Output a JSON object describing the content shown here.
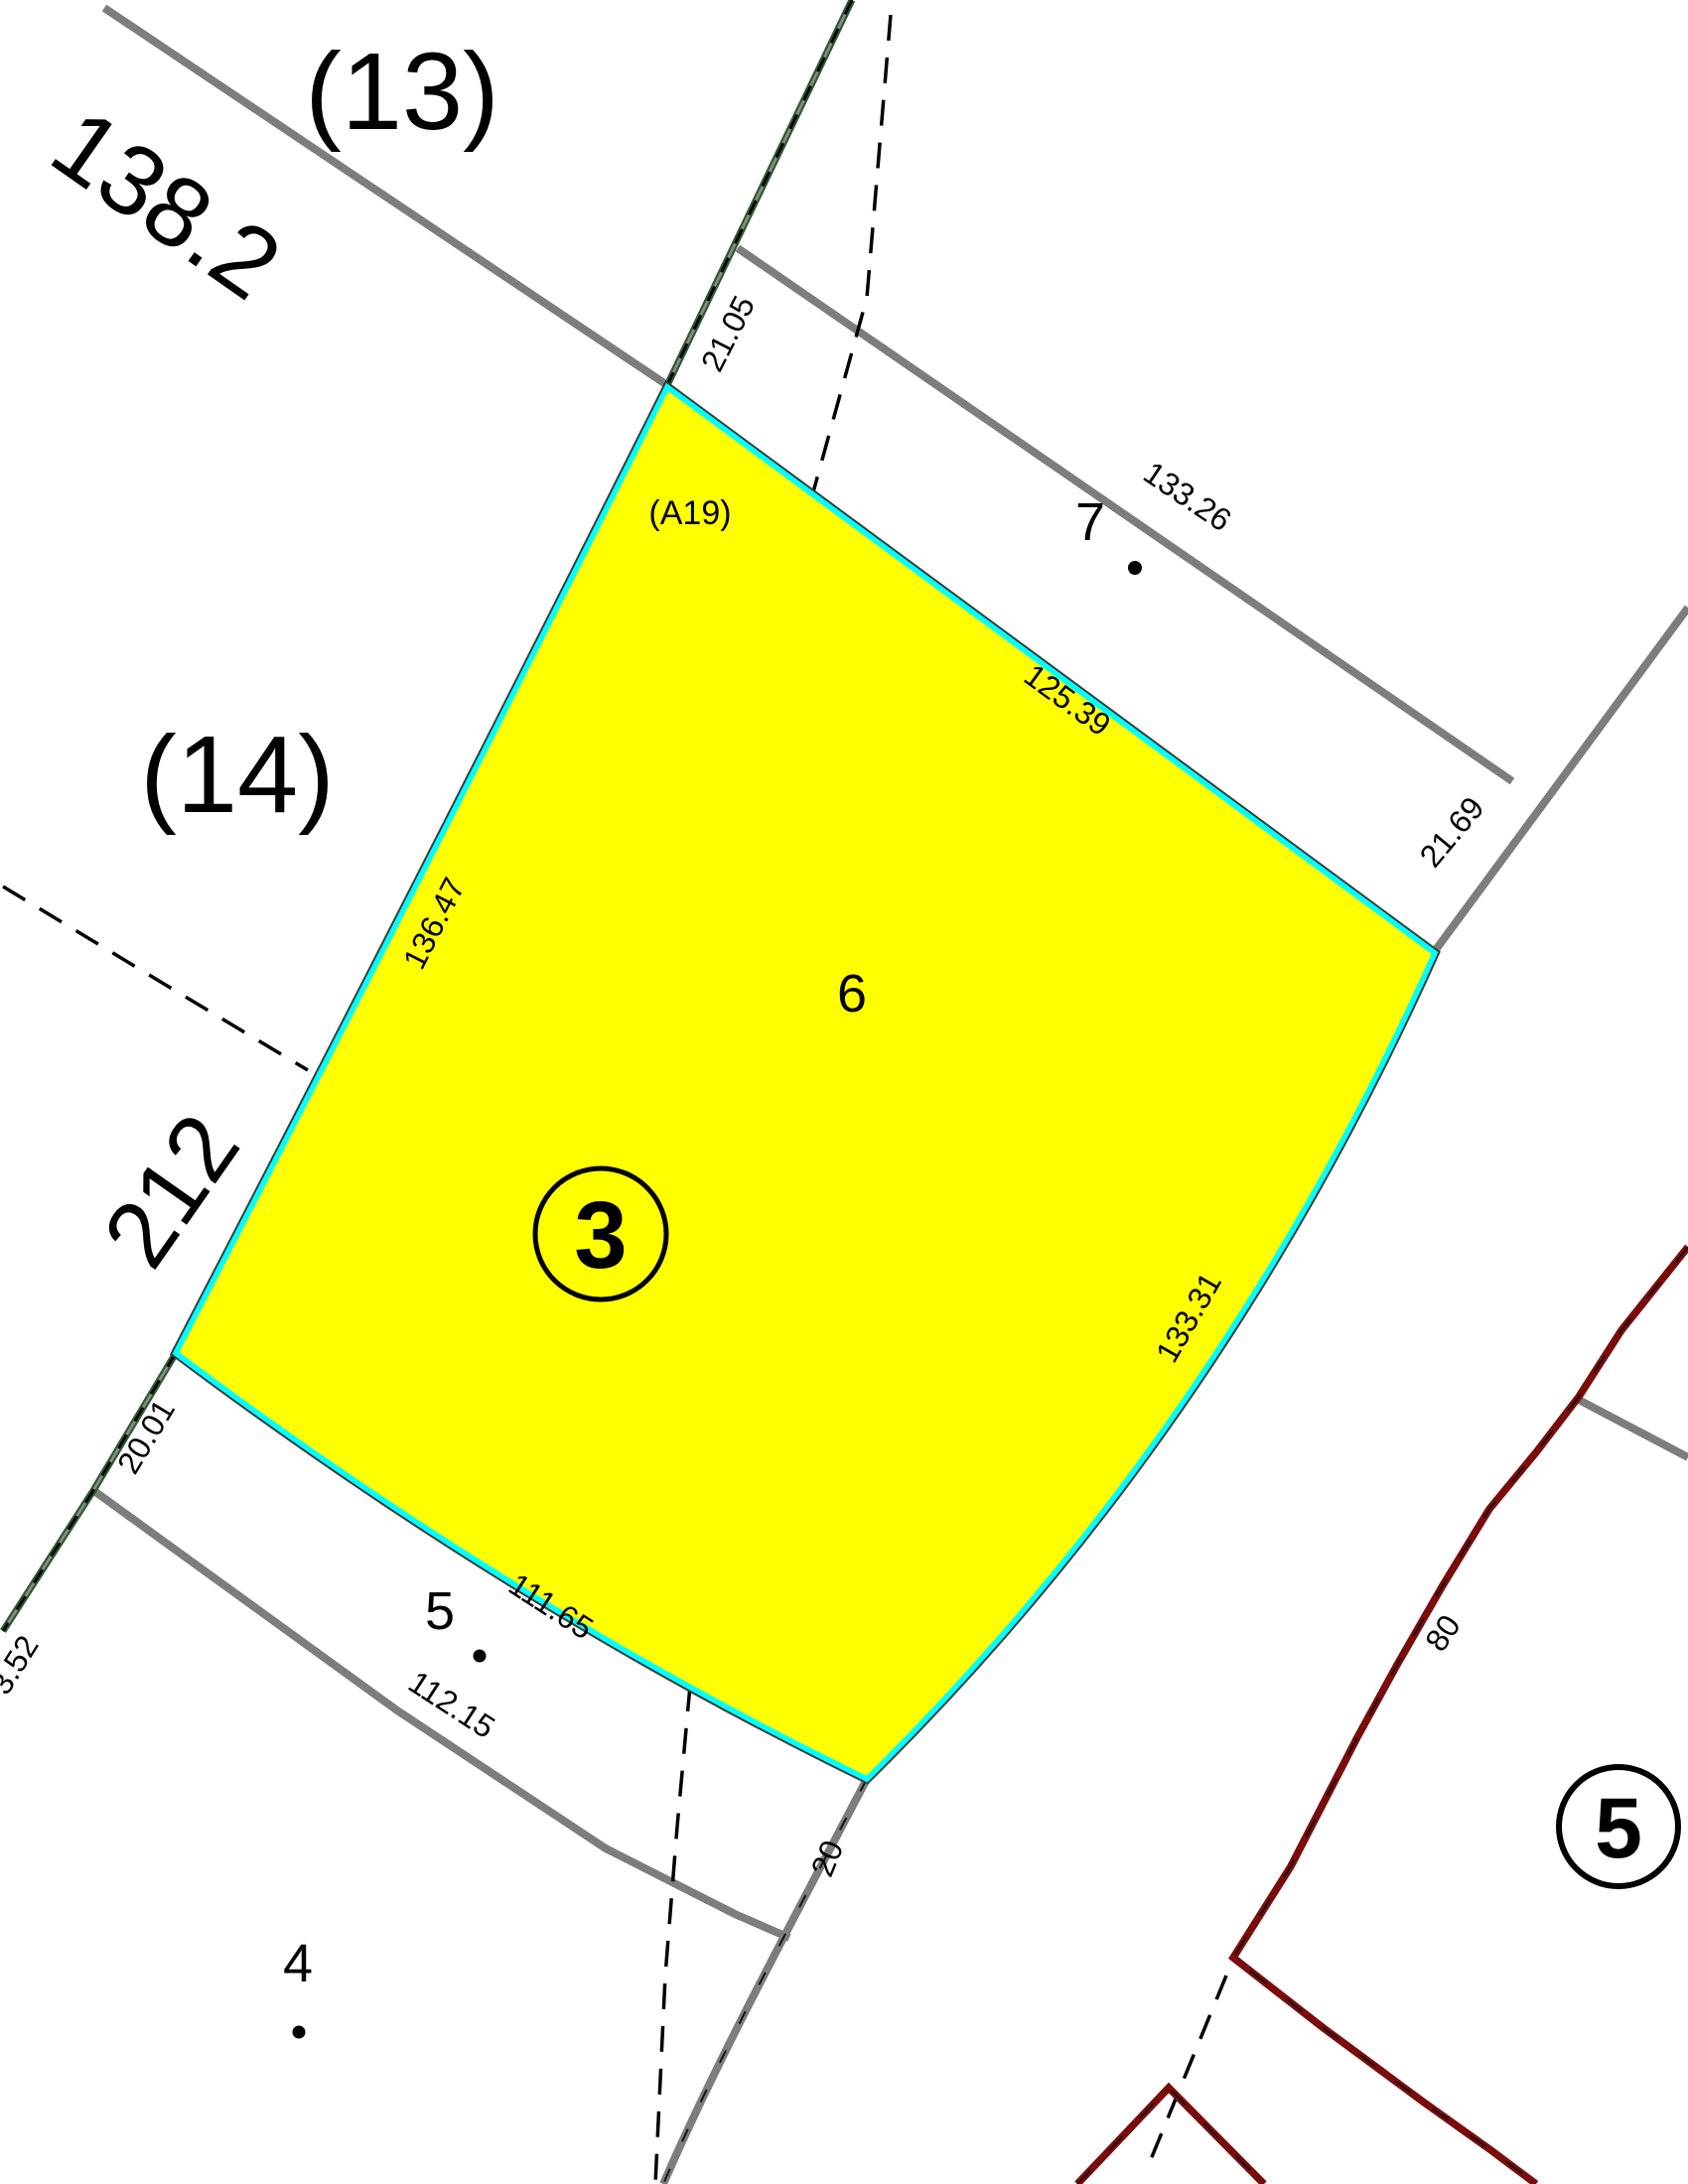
{
  "colors": {
    "parcel-fill": "#ffff00",
    "parcel-highlight": "#00ffff",
    "road-gray": "#7d7d7d",
    "boundary-green": "#2d5a2d",
    "boundary-maroon": "#7a0c0c",
    "ink": "#000000",
    "outline-dark": "#3c3c3c"
  },
  "parcel": {
    "number": "6",
    "annotation": "3",
    "code": "(A19)",
    "dims": {
      "top": "125.39",
      "right": "133.31",
      "bottom": "111.65",
      "left": "136.47"
    }
  },
  "localities": {
    "l13": "(13)",
    "l14": "(14)"
  },
  "roads": {
    "r138": "138.2",
    "r212": "212"
  },
  "widths": {
    "w2105": "21.05",
    "w2169": "21.69",
    "w2001": "20.01",
    "w20": "20",
    "w352": "3.52"
  },
  "neighbors": {
    "p7": "7",
    "p5": "5",
    "p4": "4",
    "p5c": "5",
    "d13326": "133.26",
    "d11215": "112.15",
    "d80": "80"
  }
}
